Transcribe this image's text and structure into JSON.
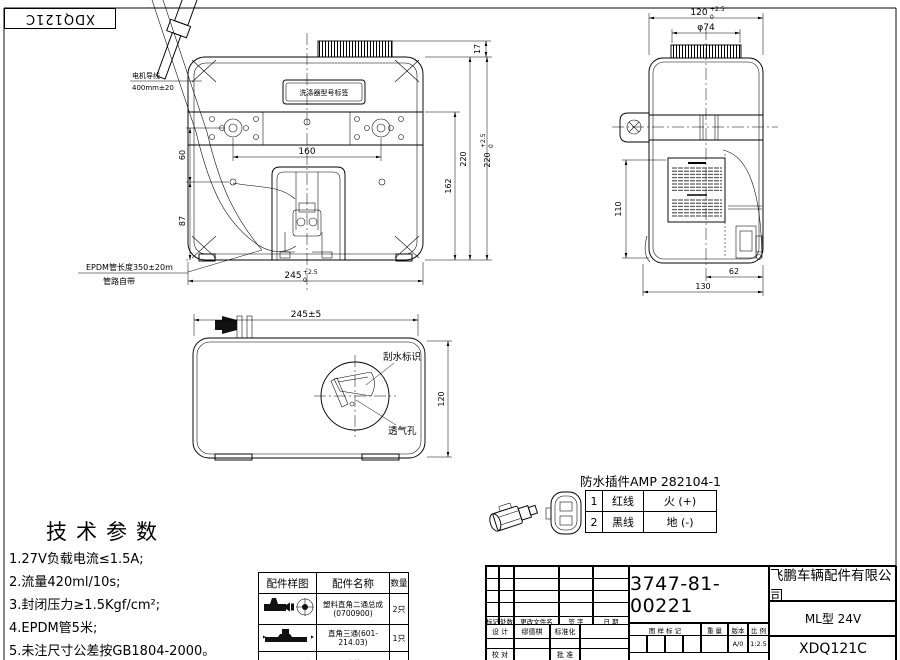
{
  "sheet": {
    "corner_code": "XDQ121C"
  },
  "notes": {
    "motor_wire_line1": "电机导线",
    "motor_wire_line2": "400mm±20",
    "plate_label": "洗涤器型号标签",
    "epdm_line1": "EPDM管长度350±20m",
    "epdm_line2": "管路自带"
  },
  "front_view": {
    "dim_hole_spacing": "160",
    "dim_60": "60",
    "dim_87": "87",
    "dim_width_base": "245",
    "dim_width_tol_up": "+2.5",
    "dim_width_tol_dn": "0",
    "dim_cap_17": "17",
    "dim_162": "162",
    "dim_220": "220",
    "dim_height_base": "220",
    "dim_height_tol_up": "+2.5",
    "dim_height_tol_dn": "0"
  },
  "side_view": {
    "dim_depth_base": "120",
    "dim_depth_tol_up": "+2.5",
    "dim_depth_tol_dn": "0",
    "dim_cap_dia": "φ74",
    "dim_110": "110",
    "dim_62": "62",
    "dim_130": "130"
  },
  "top_view": {
    "dim_length": "245±5",
    "dim_width": "120",
    "label_wiper_mark": "刮水标识",
    "label_vent_hole": "透气孔"
  },
  "connector": {
    "title": "防水插件AMP 282104-1",
    "rows": [
      {
        "no": "1",
        "wire": "红线",
        "role": "火 (+)"
      },
      {
        "no": "2",
        "wire": "黑线",
        "role": "地 (-)"
      }
    ]
  },
  "tech_params": {
    "title": "技术参数",
    "items": [
      "1.27V负载电流≤1.5A;",
      "2.流量420ml/10s;",
      "3.封闭压力≥1.5Kgf/cm²;",
      "4.EPDM管5米;",
      "5.未注尺寸公差按GB1804-2000。"
    ]
  },
  "parts_table": {
    "headers": [
      "配件样图",
      "配件名称",
      "数量"
    ],
    "rows": [
      {
        "name": "塑料直角二通总成",
        "code": "(0700900)",
        "qty": "2只"
      },
      {
        "name": "直角三通(601-214.03)",
        "code": "",
        "qty": "1只"
      },
      {
        "name": "EPDM水管(101-04071)",
        "code": "",
        "qty": "5m"
      }
    ]
  },
  "title_block": {
    "part_number": "3747-81-00221",
    "company": "飞鹏车辆配件有限公司",
    "model": "ML型 24V",
    "drawing_code": "XDQ121C",
    "rev_headers": {
      "mark": "标记",
      "count": "处数",
      "file": "更改文件名",
      "sign": "签 字",
      "date": "日 期"
    },
    "sign_rows": {
      "design": "设 计",
      "designer": "缪德棋",
      "standard": "标准化",
      "check": "校 对",
      "approve": "批 准"
    },
    "stamp_headers": {
      "mark": "图 样 标 记",
      "weight": "重 量",
      "version": "版本",
      "scale": "比 例"
    },
    "version_value": "A/0",
    "scale_value": "1:2.5"
  }
}
